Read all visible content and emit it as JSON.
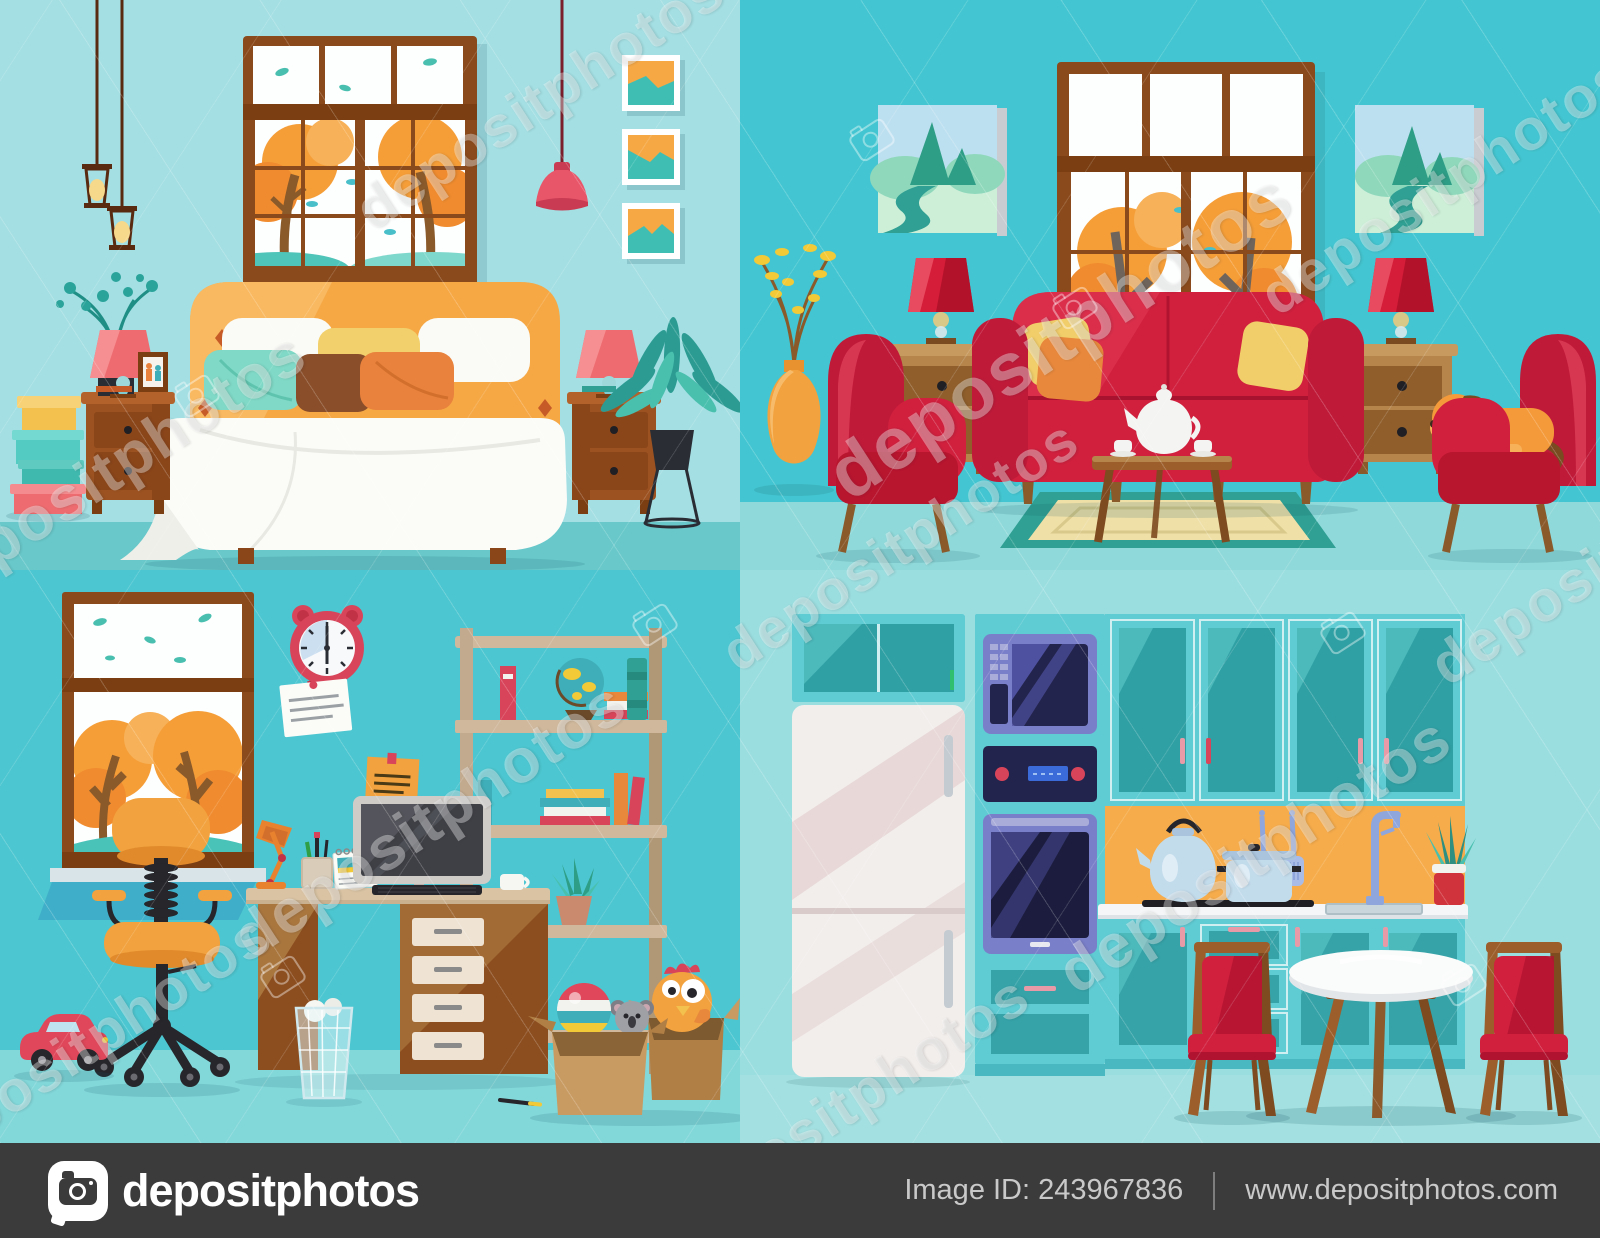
{
  "canvas": {
    "width": 1600,
    "height": 1238
  },
  "watermark": {
    "text": "depositphotos",
    "camera_icon": "camera-outline-icon",
    "color": "rgba(255,255,255,0.36)"
  },
  "footer": {
    "logo_icon": "depositphotos-camera-logo",
    "brand": "depositphotos",
    "image_id_text": "Image ID: 243967836",
    "website": "www.depositphotos.com",
    "background": "#3B3B3B",
    "text_color": "#C9C9C9"
  },
  "scenes": [
    {
      "id": "bedroom",
      "title": "Bedroom with bed, window and nightstands"
    },
    {
      "id": "living-room",
      "title": "Living room with red sofa, armchairs and sleeping dog"
    },
    {
      "id": "kids-room",
      "title": "Kids room with desk, office chair, bookshelf and toys"
    },
    {
      "id": "kitchen",
      "title": "Kitchen with teal cabinets, fridge and dining table"
    }
  ],
  "palette": {
    "bedroom_wall": "#A3DFE3",
    "bedroom_floor": "#68C8CA",
    "living_wall": "#43C6D1",
    "living_floor": "#8FD9DA",
    "kids_wall": "#4CC6D0",
    "kids_floor": "#82D7D9",
    "kitchen_wall": "#9BDEE0",
    "kitchen_floor": "#A3E0E1",
    "accent_red": "#D0203E",
    "coral": "#EE6C70",
    "orange": "#F6A845",
    "autumn_tree": "#F59E38",
    "wood_frame": "#8B4A1B",
    "wood_mid": "#A9763E",
    "backsplash": "#F6AC4B",
    "cabinet_teal": "#5FCBD3",
    "cabinet_glass": "#35A3A8",
    "appliance_purple": "#7A7FC9",
    "footer_bg": "#3B3B3B",
    "footer_text": "#C9C9C9"
  }
}
